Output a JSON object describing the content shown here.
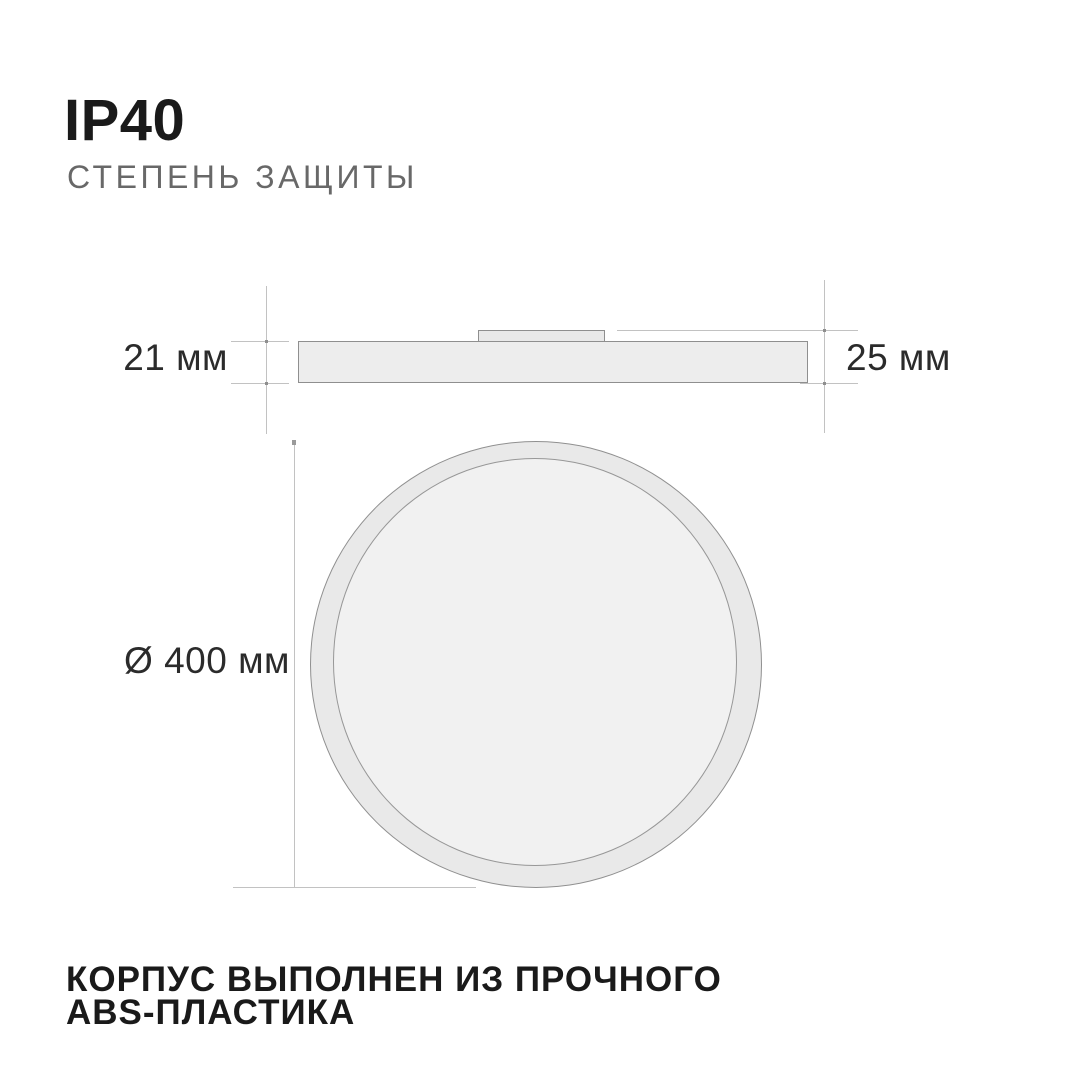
{
  "header": {
    "title": "IP40",
    "subtitle": "СТЕПЕНЬ ЗАЩИТЫ"
  },
  "side_view": {
    "height_label": "21 мм",
    "total_height_label": "25 мм"
  },
  "top_view": {
    "diameter_label": "Ø 400 мм"
  },
  "footer": {
    "line1": "КОРПУС ВЫПОЛНЕН ИЗ ПРОЧНОГО",
    "line2": "ABS-ПЛАСТИКА"
  },
  "colors": {
    "background": "#ffffff",
    "shape_fill": "#ededed",
    "ring_fill": "#e9e9e9",
    "inner_face_fill": "#f1f1f1",
    "shape_stroke": "#8f8f8f",
    "dimension_line": "#c2c2c2",
    "title_text": "#1a1a1a",
    "subtitle_text": "#686868",
    "dimension_text": "#2b2b2b"
  }
}
